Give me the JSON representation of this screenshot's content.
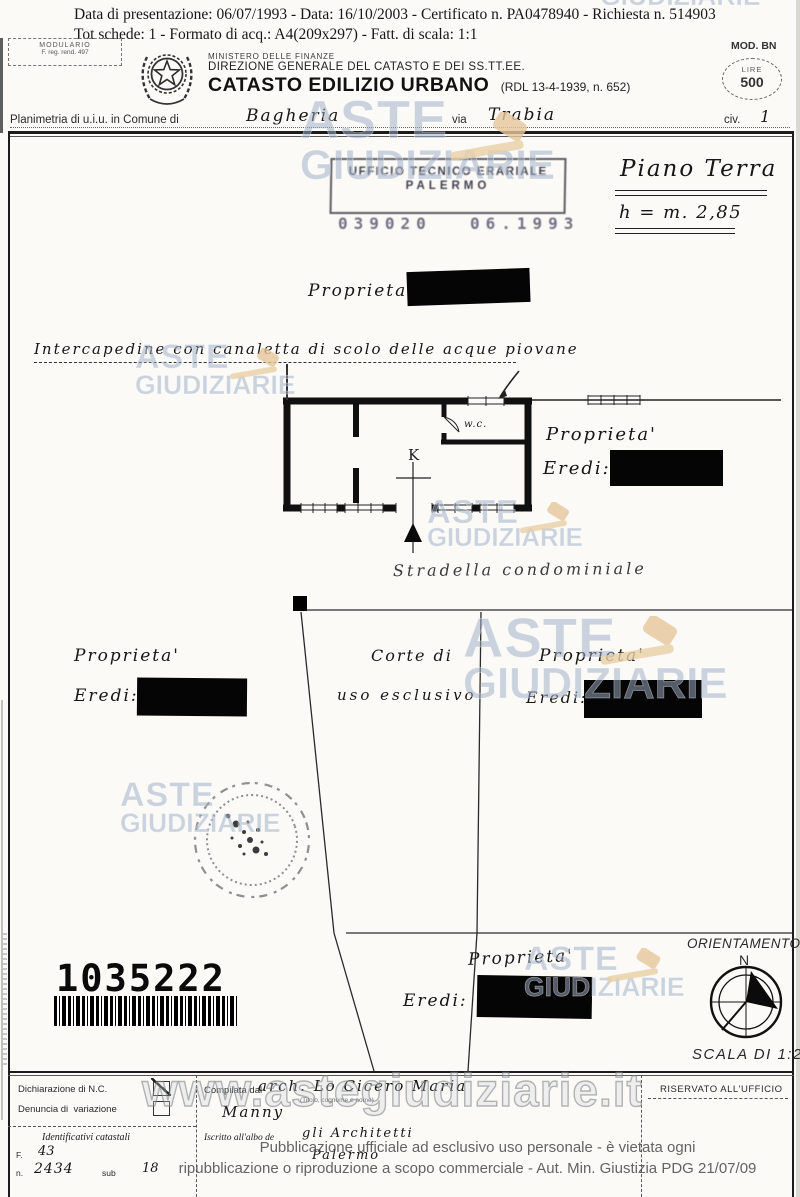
{
  "doc": {
    "top_line1": "Data di presentazione: 06/07/1993 - Data: 16/10/2003 - Certificato n. PA0478940 - Richiesta n. 514903",
    "top_line2": "Tot schede: 1 - Formato di acq.: A4(209x297) - Fatt. di scala: 1:1"
  },
  "header": {
    "modulario_line1": "MODULARIO",
    "modulario_line2": "F. reg. rend. 497",
    "ministry": "MINISTERO DELLE FINANZE",
    "direction": "DIREZIONE GENERALE DEL CATASTO E DEI SS.TT.EE.",
    "title": "CATASTO EDILIZIO URBANO",
    "title_ref": "(RDL 13-4-1939, n. 652)",
    "mod_label": "MOD. BN",
    "lire_label": "LIRE",
    "lire_value": "500"
  },
  "planimetria": {
    "label_comune": "Planimetria di u.i.u. in Comune di",
    "comune": "Bagheria",
    "label_via": "via",
    "via": "Trabia",
    "label_civ": "civ.",
    "civ": "1"
  },
  "stamp": {
    "line1": "UFFICIO TECNICO ERARIALE",
    "line2": "PALERMO",
    "num1": "039020",
    "num2": "06.1993"
  },
  "plan": {
    "floor_label": "Piano Terra",
    "height_label": "h = m. 2,85",
    "prop": "Proprieta'",
    "eredi": "Eredi:",
    "note": "Intercapedine con canaletta di scolo delle acque piovane",
    "wc": "w.c.",
    "kitchen": "K",
    "street": "Stradella condominiale",
    "court_line1": "Corte di",
    "court_line2": "uso esclusivo",
    "barcode": "1035222",
    "orientation": "ORIENTAMENTO",
    "north": "N",
    "scale": "SCALA DI 1:2"
  },
  "form": {
    "dichiarazione": "Dichiarazione di N.C.",
    "denuncia": "Denuncia di  variazione",
    "identificativi": "Identificativi catastali",
    "f_label": "F.",
    "f_value": "43",
    "n_label": "n.",
    "n_value": "2434",
    "sub_label": "sub",
    "sub_value": "18",
    "compilata_label": "Compilata dal",
    "compilata_name": "arch. Lo Cicero Maria",
    "compilata_name2": "Manny",
    "compilata_caption": "(Titolo, cognome e nome)",
    "iscritto_label": "Iscritto all'albo de",
    "iscritto_value": "gli Architetti",
    "iscritto_city": "Palermo",
    "riservato": "RISERVATO ALL'UFFICIO"
  },
  "watermark": {
    "line1": "ASTE",
    "line2": "GIUDIZIARIE",
    "url": "www.astegiudiziarie.it"
  },
  "disclaimer": {
    "line1": "Pubblicazione ufficiale ad esclusivo uso personale - è vietata ogni",
    "line2": "ripubblicazione o riproduzione a scopo commerciale - Aut. Min. Giustizia PDG 21/07/09"
  }
}
